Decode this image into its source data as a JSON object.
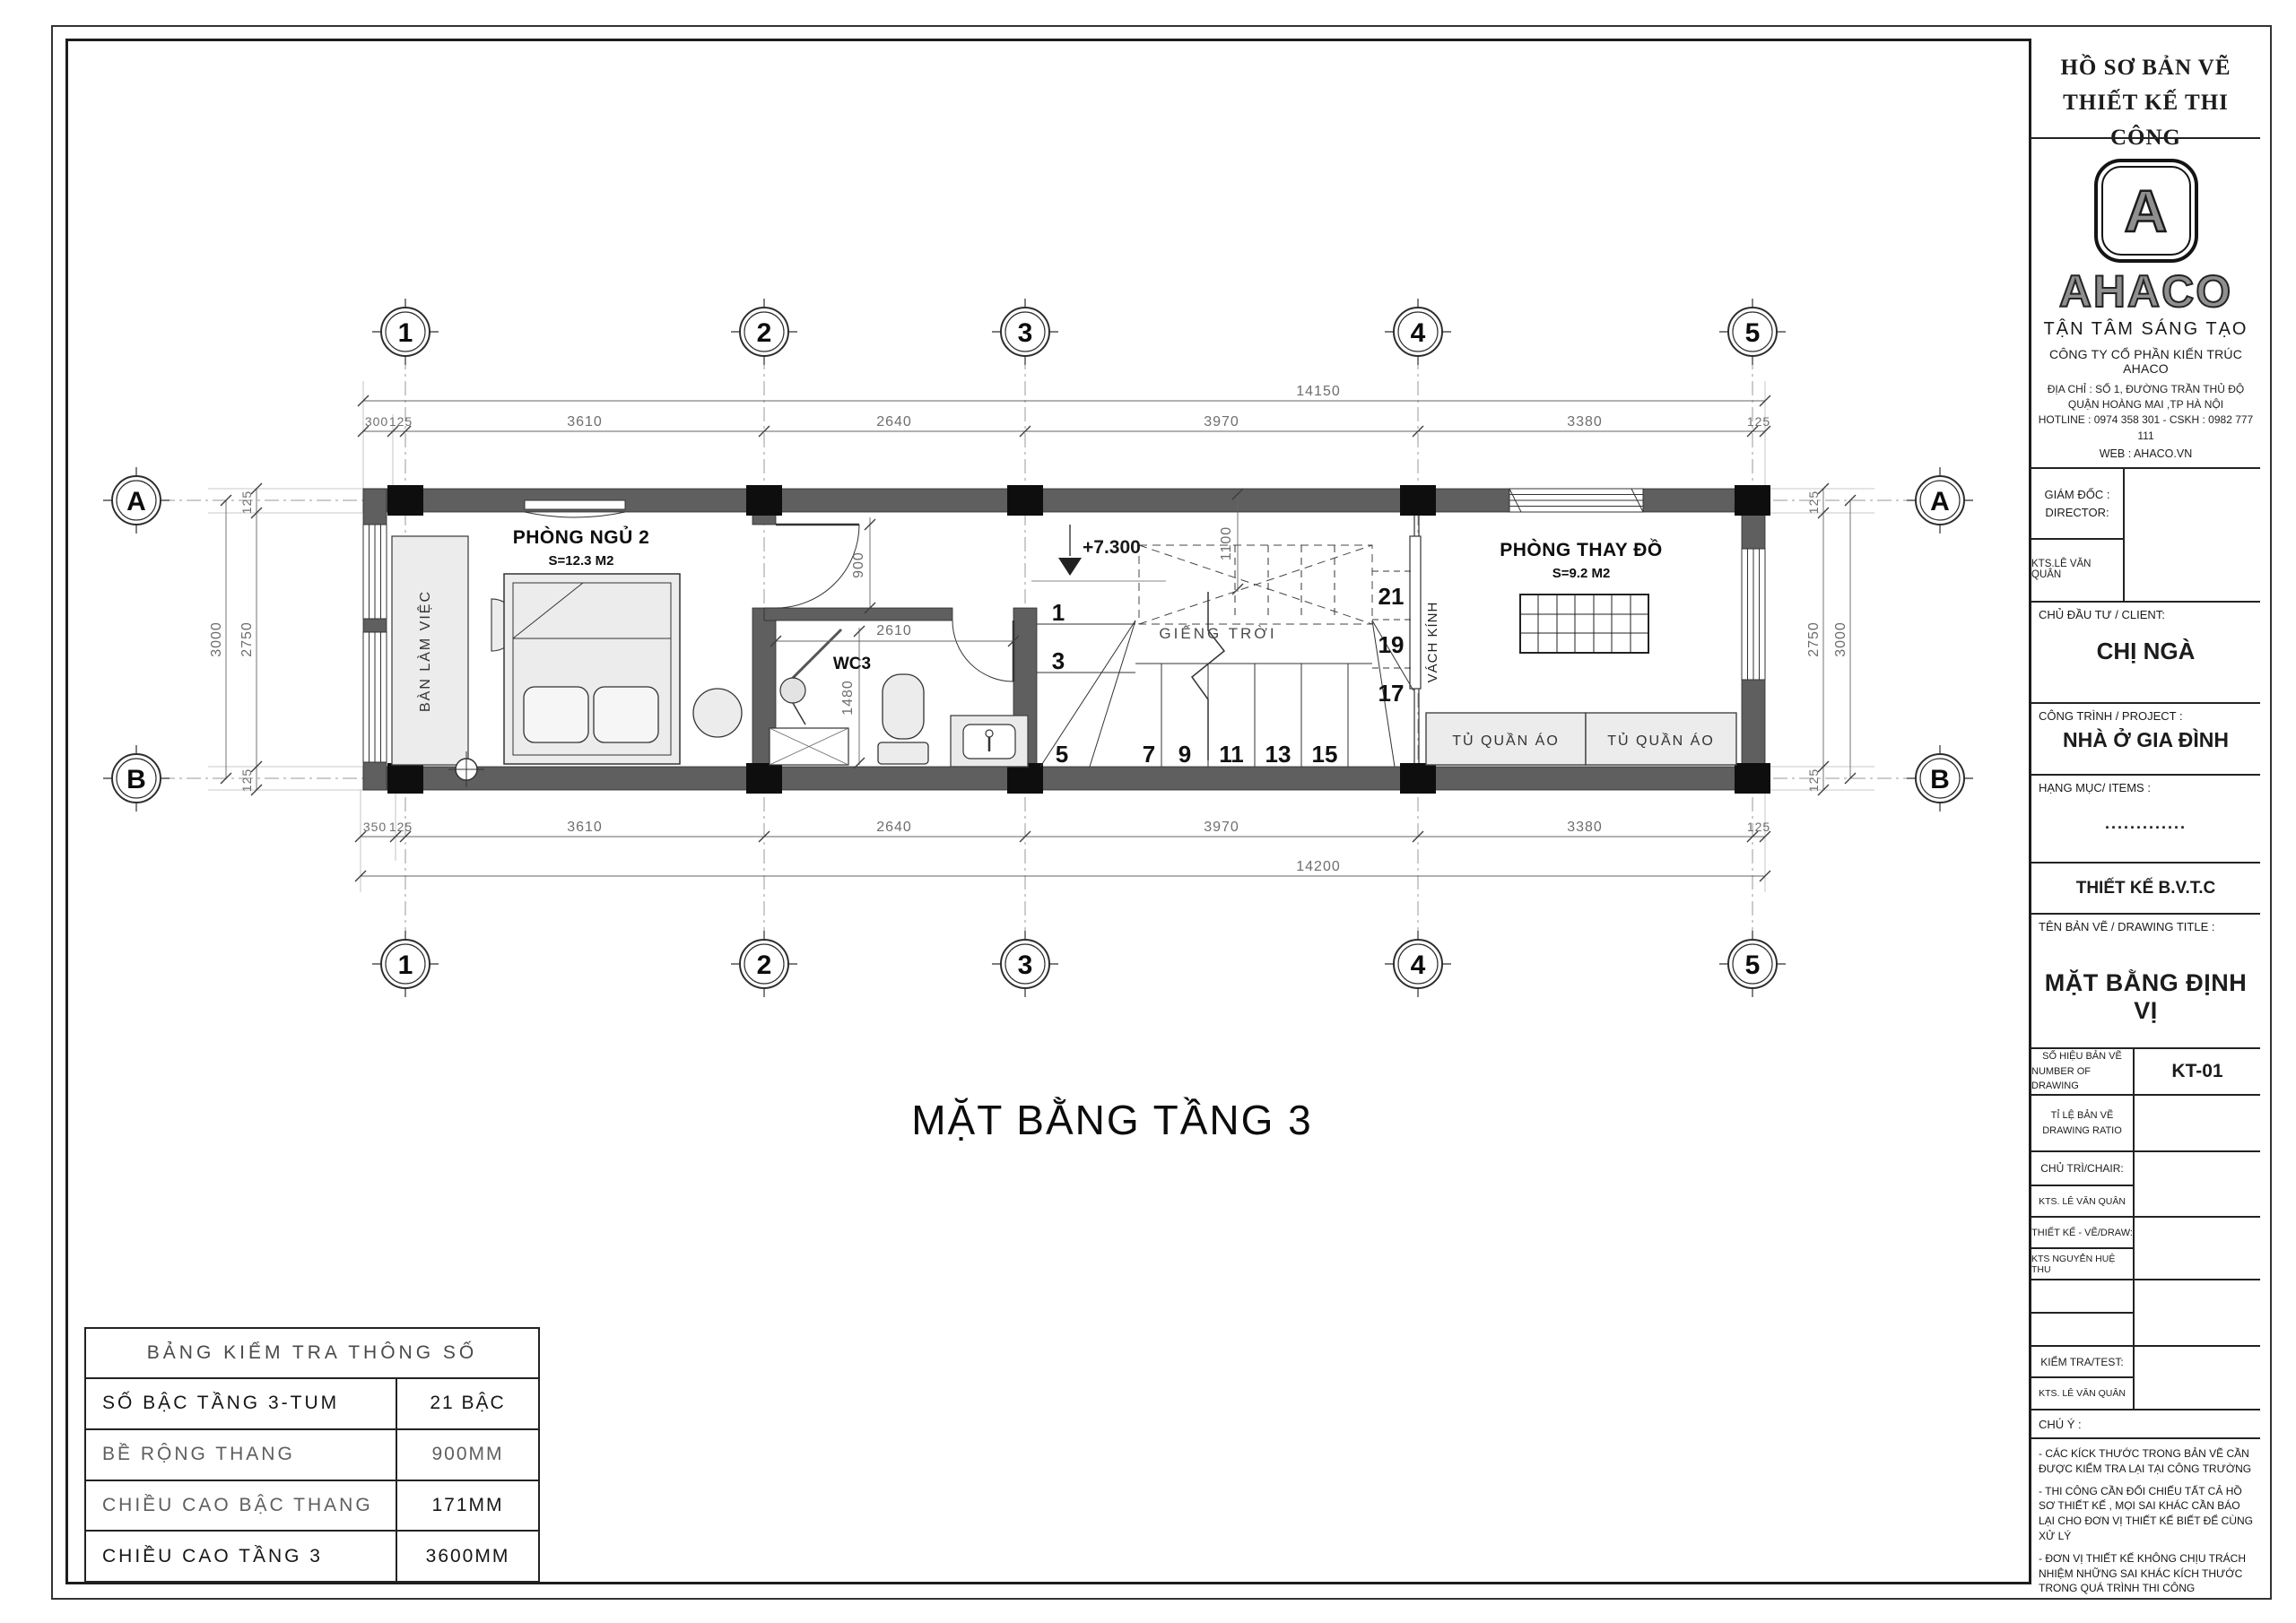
{
  "colors": {
    "wall": "#5f5f5f",
    "column": "#0e0e0e",
    "brand_gray": "#8f8f8f"
  },
  "sheet": {
    "header": {
      "line1": "HỒ SƠ BẢN VẼ",
      "line2": "THIẾT KẾ THI CÔNG"
    },
    "brand": {
      "logo_letter": "A",
      "name": "AHACO",
      "slogan": "TẬN TÂM SÁNG TẠO",
      "company": "CÔNG TY CỔ PHẦN KIẾN TRÚC AHACO",
      "address1": "ĐỊA CHỈ : SỐ 1, ĐƯỜNG TRẦN THỦ ĐỘ",
      "address2": "QUẬN HOÀNG MAI ,TP HÀ NỘI",
      "hotline": "HOTLINE :  0974 358 301   -   CSKH : 0982 777 111",
      "web": "WEB : AHACO.VN"
    },
    "director": {
      "label1": "GIÁM ĐỐC :",
      "label2": "DIRECTOR:",
      "name": "KTS.LÊ VĂN QUÂN"
    },
    "client": {
      "label": "CHỦ ĐẦU TƯ / CLIENT:",
      "name": "CHỊ NGÀ"
    },
    "project": {
      "label": "CÔNG TRÌNH / PROJECT :",
      "name": "NHÀ Ở GIA ĐÌNH"
    },
    "items": {
      "label": "HẠNG MỤC/ ITEMS :",
      "value": "............."
    },
    "stage": "THIẾT KẾ B.V.T.C",
    "drawing": {
      "label": "TÊN BẢN VẼ / DRAWING TITLE :",
      "title": "MẶT BẰNG ĐỊNH VỊ"
    },
    "number": {
      "label1": "SỐ HIỆU BẢN VẼ",
      "label2": "NUMBER OF DRAWING",
      "value": "KT-01"
    },
    "ratio": {
      "label1": "TỈ LỆ BẢN VẼ",
      "label2": "DRAWING RATIO"
    },
    "chair": {
      "label": "CHỦ TRÌ/CHAIR:",
      "name": "KTS. LÊ VĂN QUÂN"
    },
    "draw": {
      "label": "THIẾT KẾ - VẼ/DRAW:",
      "name": "KTS NGUYỄN HUỆ THU"
    },
    "test": {
      "label": "KIỂM TRA/TEST:",
      "name": "KTS. LÊ VĂN QUÂN"
    },
    "note": {
      "label": "CHÚ Ý :",
      "n1": "- CÁC KÍCK THƯỚC TRONG BẢN VẼ CẦN ĐƯỢC KIỂM TRA LẠI TẠI CÔNG TRƯỜNG",
      "n2": "- THI CÔNG CẦN ĐỐI CHIẾU TẤT CẢ HỒ SƠ THIẾT KẾ , MỌI SAI KHÁC CẦN BÁO LẠI CHO ĐƠN VỊ THIẾT KẾ BIẾT ĐỂ CÙNG XỬ LÝ",
      "n3": "- ĐƠN VỊ THIẾT KẾ KHÔNG CHỊU TRÁCH NHIỆM NHỮNG SAI KHÁC KÍCH THƯỚC TRONG QUÁ TRÌNH THI CÔNG"
    }
  },
  "plan": {
    "title": "MẶT BẰNG TẦNG 3",
    "grid": {
      "cols": [
        "1",
        "2",
        "3",
        "4",
        "5"
      ],
      "rows": [
        "A",
        "B"
      ]
    },
    "labels": {
      "bedroom": "PHÒNG NGỦ 2",
      "bedroom_area": "S=12.3 M2",
      "wc": "WC3",
      "desk": "BÀN LÀM VIỆC",
      "lightwell": "GIẾNG TRỜI",
      "glass": "VÁCH KÍNH",
      "dressing": "PHÒNG THAY ĐỒ",
      "dressing_area": "S=9.2 M2",
      "wardrobe": "TỦ QUẦN ÁO",
      "level": "+7.300"
    },
    "dims": {
      "top_total": "14150",
      "bottom_total": "14200",
      "top": [
        "300",
        "125",
        "3610",
        "2640",
        "3970",
        "3380",
        "125"
      ],
      "bottom": [
        "350",
        "125",
        "3610",
        "2640",
        "3970",
        "3380",
        "125"
      ],
      "side": {
        "a": "125",
        "b": "2750",
        "c": "125",
        "total": "3000"
      },
      "inner": {
        "door": "900",
        "wc_w": "2610",
        "wc_d": "1480",
        "well": "1100"
      }
    },
    "stairs": [
      "1",
      "3",
      "5",
      "7",
      "9",
      "11",
      "13",
      "15",
      "17",
      "19",
      "21"
    ]
  },
  "check_table": {
    "title": "BẢNG KIỂM TRA THÔNG SỐ",
    "rows": [
      {
        "label": "SỐ BẬC TẦNG 3-TUM",
        "value": "21 BẬC"
      },
      {
        "label": "BỀ RỘNG THANG",
        "value": "900MM"
      },
      {
        "label": "CHIỀU CAO BẬC THANG",
        "value": "171MM"
      },
      {
        "label": "CHIỀU CAO TẦNG 3",
        "value": "3600MM"
      }
    ]
  }
}
